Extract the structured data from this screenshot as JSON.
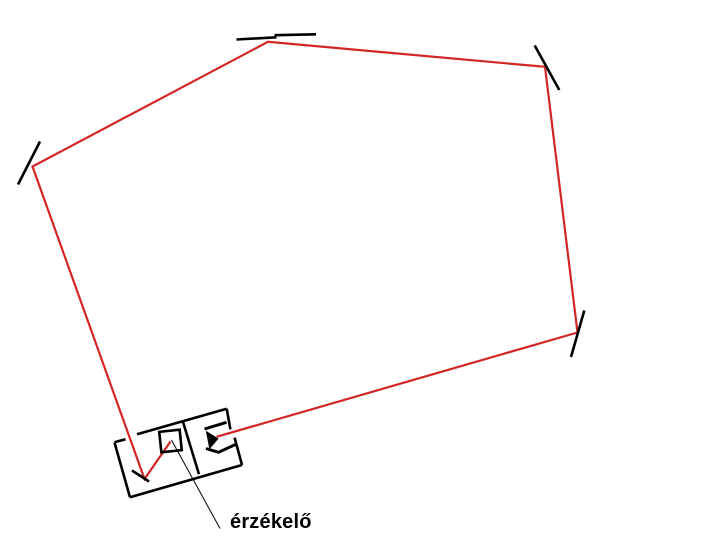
{
  "diagram": {
    "background": "#ffffff",
    "ink_color": "#000000",
    "beam": {
      "color": "#d42525",
      "width": 2.2,
      "path": [
        [
          170.5,
          441.5
        ],
        [
          144.5,
          479
        ],
        [
          32.5,
          166.5
        ],
        [
          268,
          41.8
        ],
        [
          545,
          66.8
        ],
        [
          577.5,
          332.5
        ],
        [
          216.5,
          436.8
        ]
      ]
    },
    "mirrors": {
      "stroke_width": 2.6,
      "segments": [
        {
          "name": "mirror-left",
          "points": [
            [
              40,
              141.5
            ],
            [
              18,
              184.5
            ]
          ]
        },
        {
          "name": "mirror-top-segment-a",
          "points": [
            [
              236.5,
              39.5
            ],
            [
              276.5,
              37.3
            ]
          ]
        },
        {
          "name": "mirror-top-segment-b",
          "points": [
            [
              274.5,
              35.2
            ],
            [
              316,
              34.3
            ]
          ]
        },
        {
          "name": "mirror-upper-right",
          "points": [
            [
              534.7,
              45.5
            ],
            [
              559.3,
              90
            ]
          ]
        },
        {
          "name": "mirror-right",
          "points": [
            [
              584.3,
              310.5
            ],
            [
              571,
              357
            ]
          ]
        },
        {
          "name": "mirror-inside-box",
          "points": [
            [
              132,
              470.5
            ],
            [
              149,
              481.5
            ]
          ]
        }
      ]
    },
    "device": {
      "stroke_width": 2.6,
      "outline": [
        {
          "name": "left-box-left-edge",
          "points": [
            [
              114.5,
              442.5
            ],
            [
              130,
              497.3
            ]
          ]
        },
        {
          "name": "left-box-top-edge-a",
          "points": [
            [
              114.5,
              442.3
            ],
            [
              125.5,
              439.2
            ]
          ]
        },
        {
          "name": "box-top-edge",
          "points": [
            [
              137,
              434.2
            ],
            [
              226.7,
              408.7
            ]
          ]
        },
        {
          "name": "box-divider-edge",
          "points": [
            [
              182.8,
              421.3
            ],
            [
              199,
              474.3
            ]
          ]
        },
        {
          "name": "box-bottom-edge",
          "points": [
            [
              130,
              497.3
            ],
            [
              242,
              465
            ]
          ]
        },
        {
          "name": "right-box-right-edge-a",
          "points": [
            [
              226.7,
              408.7
            ],
            [
              230.4,
              429.4
            ]
          ]
        },
        {
          "name": "right-box-right-edge-b",
          "points": [
            [
              234.6,
              437.6
            ],
            [
              242,
              465
            ]
          ]
        }
      ],
      "sensor_square": {
        "cx": 170.5,
        "cy": 441,
        "size": 20.5,
        "rotation": -6,
        "stroke_width": 2.6
      },
      "detector": {
        "stroke_width": 3,
        "triangle": [
          [
            205.8,
            430.8
          ],
          [
            218.6,
            438.6
          ],
          [
            209.4,
            449.2
          ]
        ],
        "top_bar": [
          [
            204.5,
            429
          ],
          [
            226.5,
            422.3
          ]
        ],
        "bottom_hook": [
          [
            206,
            448.5
          ],
          [
            218.5,
            452.3
          ],
          [
            236.5,
            444
          ]
        ]
      }
    },
    "leader_line": {
      "width": 1,
      "points": [
        [
          171.5,
          440
        ],
        [
          220,
          528.5
        ]
      ]
    },
    "label": {
      "text": "érzékelő",
      "x": 230,
      "y": 511
    }
  }
}
